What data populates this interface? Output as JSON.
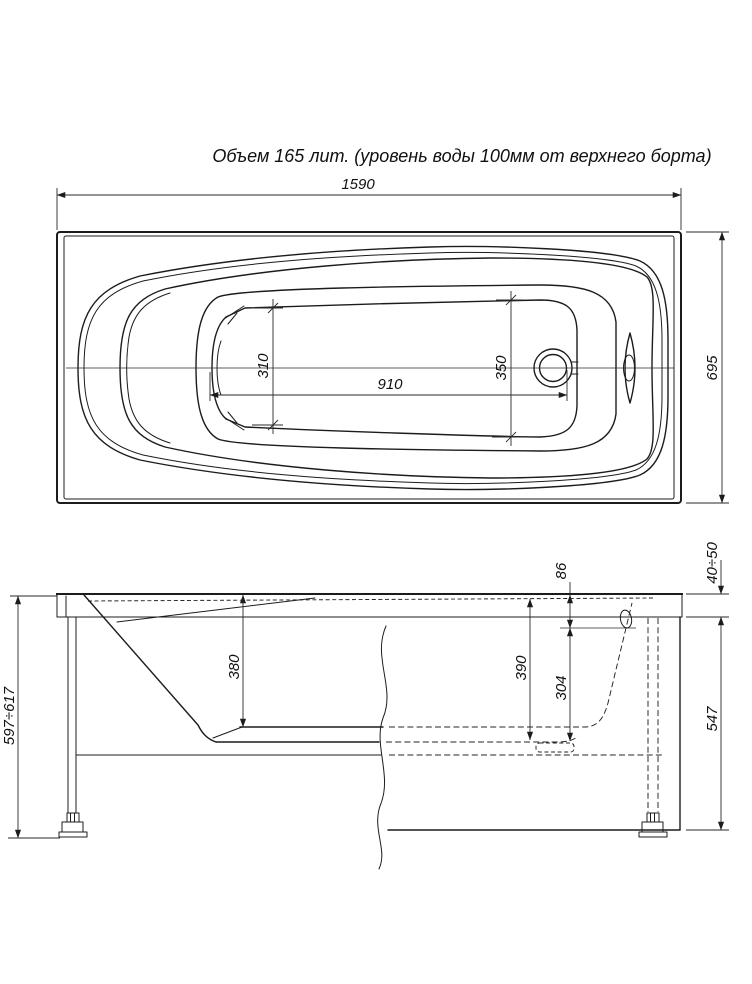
{
  "title": "Объем 165 лит. (уровень воды 100мм от верхнего борта)",
  "dims": {
    "top": {
      "overall_length": "1590",
      "overall_width": "695",
      "bottom_length": "910",
      "bottom_width_foot": "310",
      "bottom_width_head": "350"
    },
    "side": {
      "overall_height": "597÷617",
      "depth_foot": "380",
      "depth_head": "390",
      "overflow_to_bottom": "304",
      "top_to_overflow": "86",
      "rim_height": "40÷50",
      "apron_height": "547"
    }
  },
  "colors": {
    "line": "#1c1c1c",
    "dimension": "#2a2a2a",
    "background": "#ffffff"
  }
}
